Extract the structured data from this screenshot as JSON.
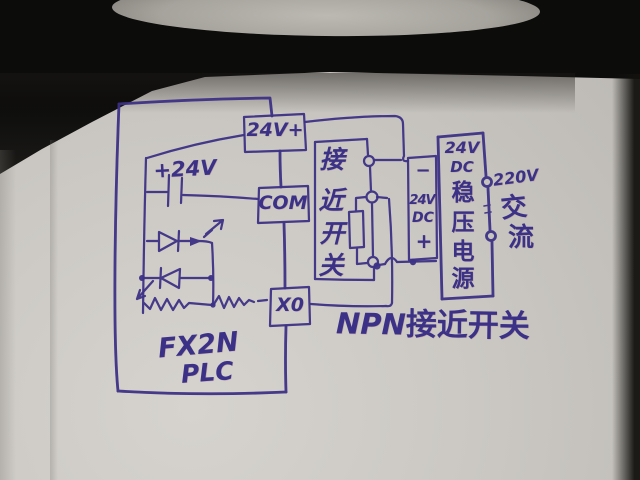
{
  "colors": {
    "ink": "#3b3287",
    "paper": "#cbc8c3",
    "shadow_band": "#13120f"
  },
  "plc": {
    "terminal_24v": "24V+",
    "terminal_com": "COM",
    "terminal_x0": "X0",
    "internal_voltage": "+24V",
    "model": "FX2N",
    "type": "PLC"
  },
  "sensor": {
    "label_chars": [
      "接",
      "近",
      "开",
      "关"
    ],
    "caption_prefix": "NPN",
    "caption_suffix": "接近开关"
  },
  "dc_terminals": {
    "minus": "−",
    "volt": "24V",
    "dc": "DC",
    "plus": "+"
  },
  "psu": {
    "lines": [
      "24V",
      "DC",
      "稳",
      "压",
      "电",
      "源"
    ]
  },
  "ac": {
    "voltage": "220V",
    "chars": [
      "交",
      "流"
    ]
  }
}
